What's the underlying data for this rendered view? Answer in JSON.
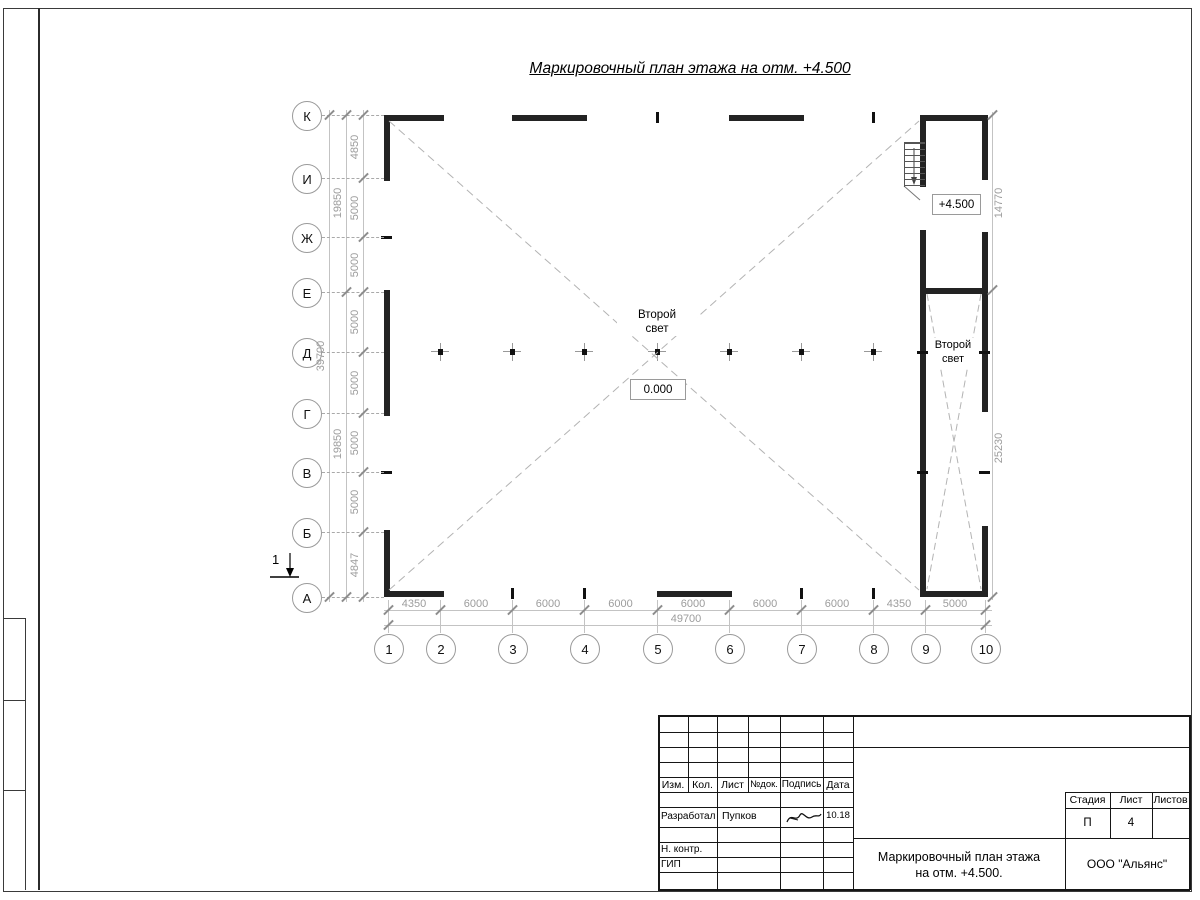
{
  "sheet": {
    "title": "Маркировочный план этажа на отм. +4.500"
  },
  "plan": {
    "hall_label_line1": "Второй",
    "hall_label_line2": "свет",
    "hall_elevation": "0.000",
    "annex_elevation": "+4.500",
    "annex_label_line1": "Второй",
    "annex_label_line2": "свет",
    "section_mark": "1"
  },
  "axes": {
    "rows": [
      "К",
      "И",
      "Ж",
      "Е",
      "Д",
      "Г",
      "В",
      "Б",
      "А"
    ],
    "cols": [
      "1",
      "2",
      "3",
      "4",
      "5",
      "6",
      "7",
      "8",
      "9",
      "10"
    ]
  },
  "dimensions": {
    "left_chain": [
      "4850",
      "5000",
      "5000",
      "5000",
      "5000",
      "5000",
      "5000",
      "4847"
    ],
    "left_mid": [
      "19850",
      "19850"
    ],
    "left_total": "39700",
    "bottom_chain": [
      "4350",
      "6000",
      "6000",
      "6000",
      "6000",
      "6000",
      "6000",
      "4350",
      "5000"
    ],
    "bottom_total": "49700",
    "right_chain": [
      "14770",
      "25230"
    ]
  },
  "titleblock": {
    "header_cells": [
      "Изм.",
      "Кол.",
      "Лист",
      "№док.",
      "Подпись",
      "Дата"
    ],
    "row_developer_role": "Разработал",
    "row_developer_name": "Пупков",
    "row_developer_date": "10.18",
    "row_ncontrol_role": "Н. контр.",
    "row_gip_role": "ГИП",
    "stage_header": [
      "Стадия",
      "Лист",
      "Листов"
    ],
    "stage_value": "П",
    "sheet_value": "4",
    "doc_title_line1": "Маркировочный план этажа",
    "doc_title_line2": "на отм. +4.500.",
    "company": "ООО \"Альянс\""
  },
  "colors": {
    "wall": "#232323",
    "dim_text": "#9c9c9c",
    "line_light": "#c3c3c3",
    "dashed_cross": "#b3b3b3"
  }
}
